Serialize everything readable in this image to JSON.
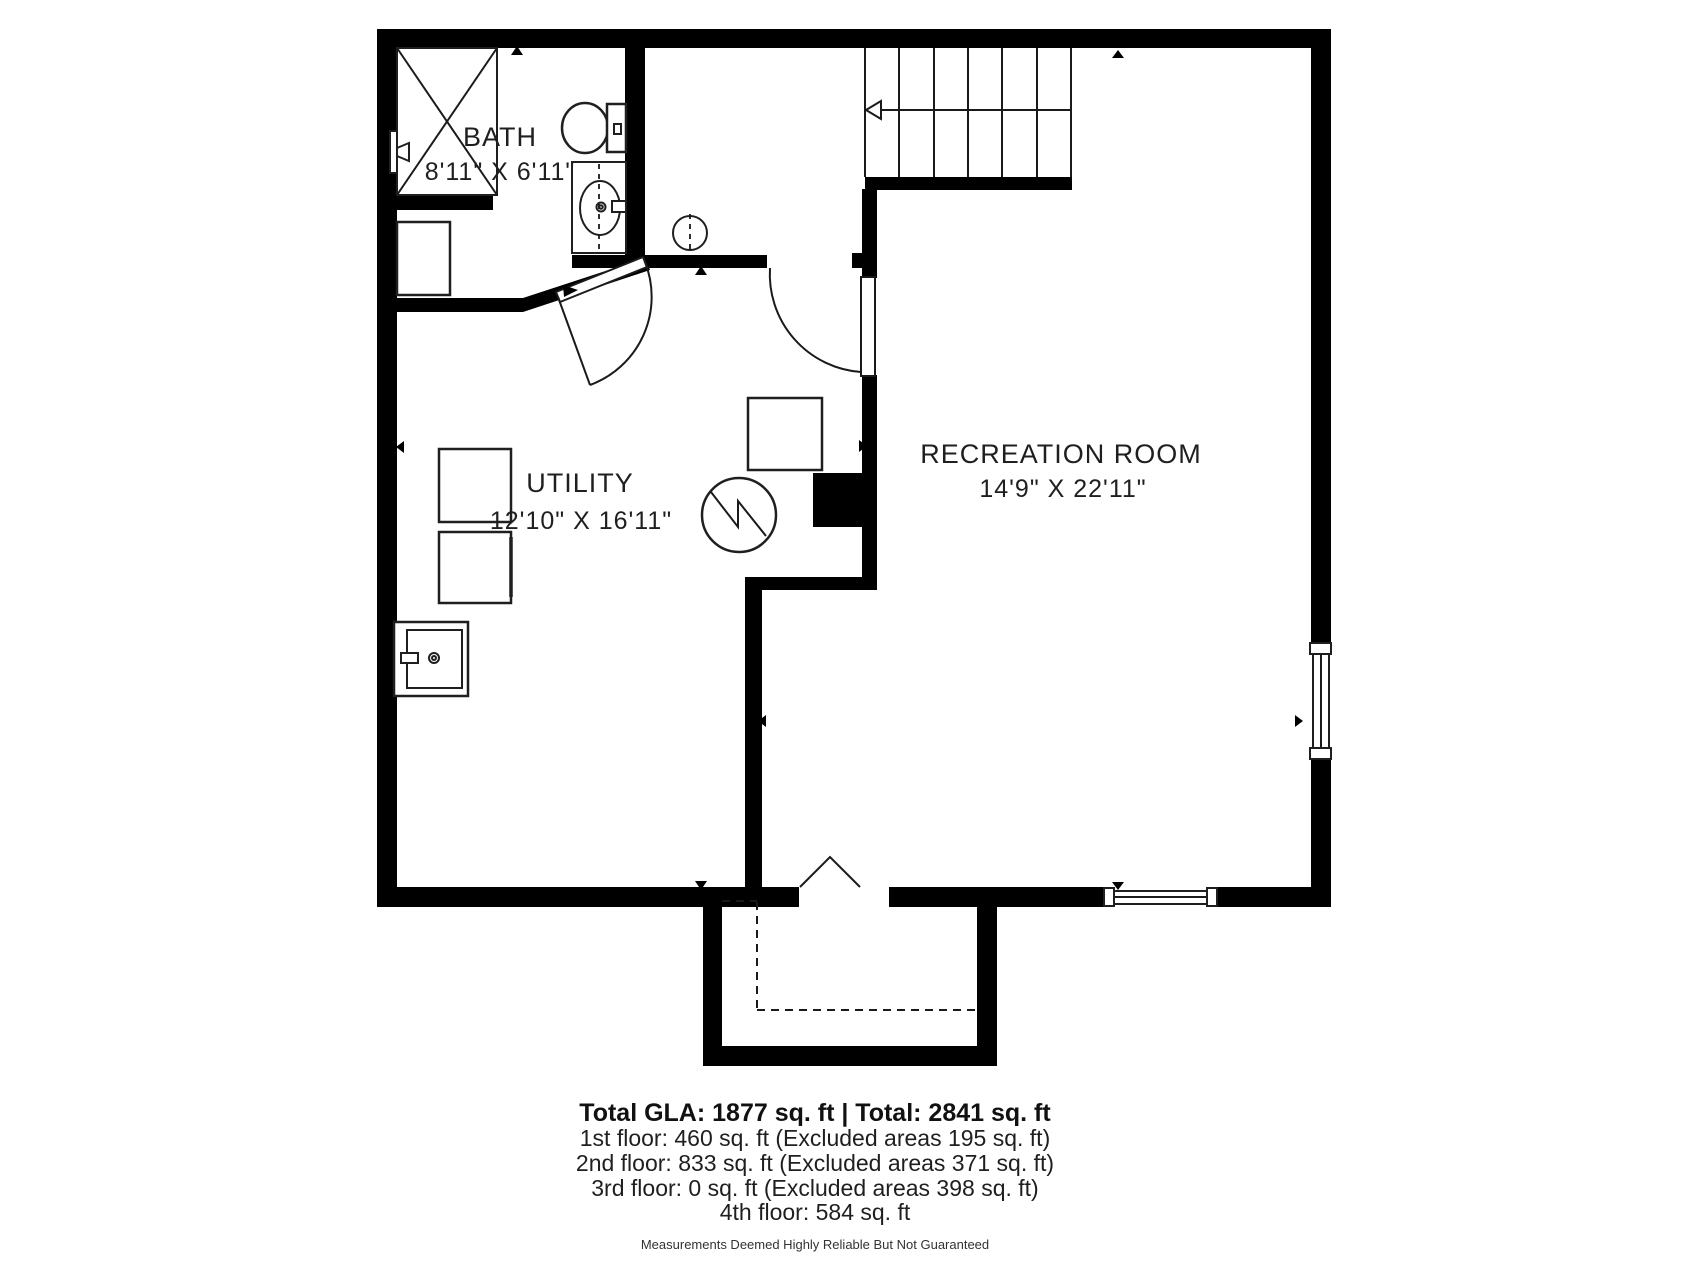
{
  "plan": {
    "type": "floorplan-basement",
    "rooms": [
      {
        "name": "BATH",
        "dims": "8'11\" X 6'11\""
      },
      {
        "name": "UTILITY",
        "dims": "12'10\" X 16'11\""
      },
      {
        "name": "RECREATION ROOM",
        "dims": "14'9\" X 22'11\""
      }
    ],
    "fixtures": [
      "shower",
      "toilet",
      "sink-vanity",
      "washer",
      "dryer",
      "storage-box",
      "laundry-sink",
      "water-heater",
      "chimney",
      "stairs",
      "entry-double-door",
      "windows"
    ]
  },
  "summary": {
    "total": "Total GLA: 1877 sq. ft | Total: 2841 sq. ft",
    "floors": [
      "1st floor: 460 sq. ft (Excluded areas 195 sq. ft)",
      "2nd floor: 833 sq. ft (Excluded areas 371 sq. ft)",
      "3rd floor: 0 sq. ft (Excluded areas 398 sq. ft)",
      "4th floor: 584 sq. ft"
    ],
    "disclaimer": "Measurements Deemed Highly Reliable But Not Guaranteed"
  },
  "colors": {
    "wall": "#000000",
    "line": "#1a1a1a",
    "text": "#1f1f1f",
    "background": "#ffffff"
  }
}
